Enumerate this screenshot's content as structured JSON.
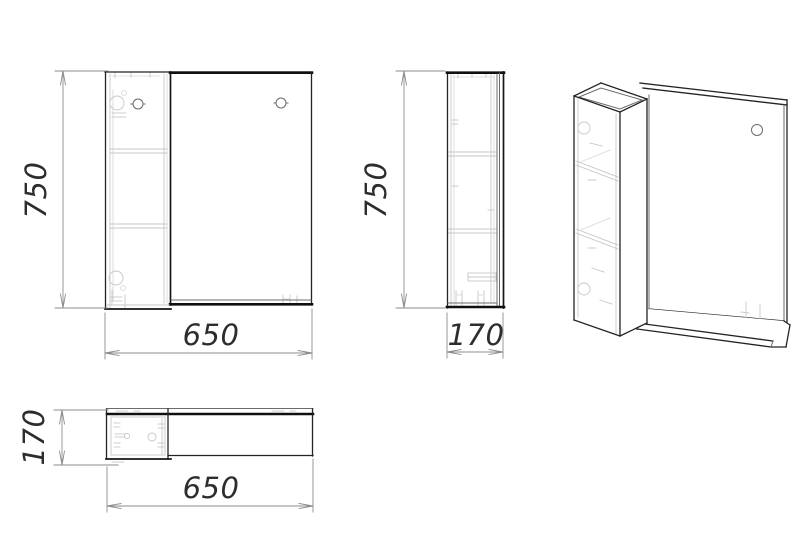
{
  "drawing": {
    "title": "wall-mirror-cabinet-orthographic-drawing",
    "background_color": "#ffffff",
    "colors": {
      "outline": "#232323",
      "heavy_edge": "#101010",
      "faint_detail": "#c7c7c7",
      "dimension_line": "#8d8d8d",
      "dimension_text": "#2d2d2d"
    },
    "views": {
      "front": {
        "height_label": "750",
        "width_label": "650"
      },
      "side": {
        "height_label": "750",
        "depth_label": "170"
      },
      "plan": {
        "depth_label": "170",
        "width_label": "650"
      },
      "isometric": {}
    }
  }
}
